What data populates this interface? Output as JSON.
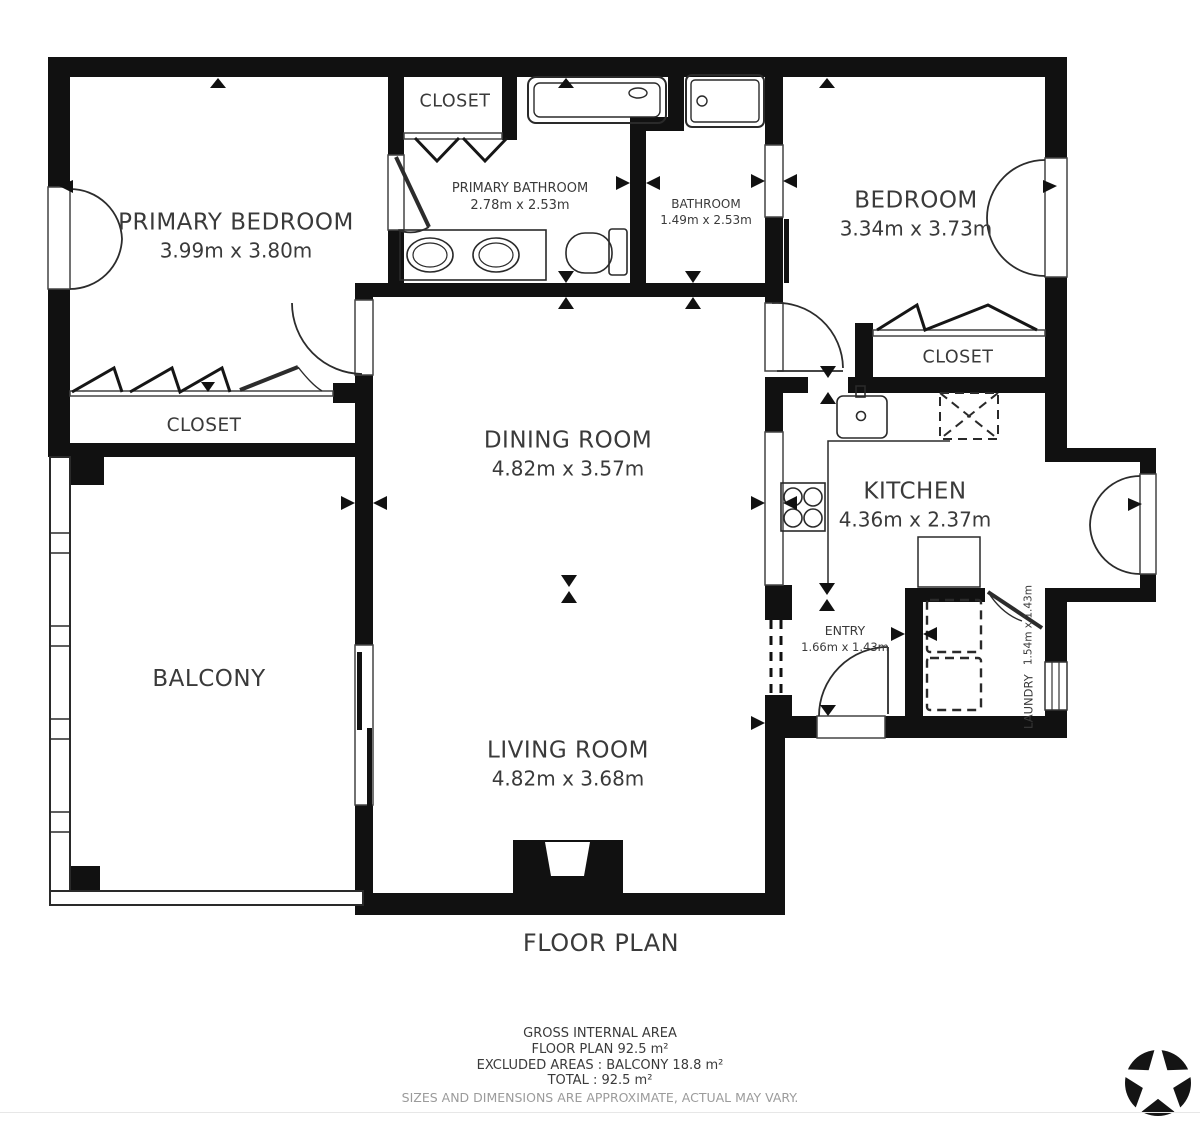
{
  "title": "FLOOR PLAN",
  "rooms": {
    "primary_bedroom": {
      "name": "PRIMARY BEDROOM",
      "dims": "3.99m x 3.80m"
    },
    "closet_top": {
      "name": "CLOSET"
    },
    "primary_bathroom": {
      "name": "PRIMARY BATHROOM",
      "dims": "2.78m x 2.53m"
    },
    "bathroom": {
      "name": "BATHROOM",
      "dims": "1.49m x 2.53m"
    },
    "bedroom": {
      "name": "BEDROOM",
      "dims": "3.34m x 3.73m"
    },
    "closet_right": {
      "name": "CLOSET"
    },
    "closet_left": {
      "name": "CLOSET"
    },
    "dining_room": {
      "name": "DINING ROOM",
      "dims": "4.82m x 3.57m"
    },
    "kitchen": {
      "name": "KITCHEN",
      "dims": "4.36m x 2.37m"
    },
    "balcony": {
      "name": "BALCONY"
    },
    "entry": {
      "name": "ENTRY",
      "dims": "1.66m x 1.43m"
    },
    "laundry": {
      "name": "LAUNDRY",
      "dims": "1.54m x 1.43m"
    },
    "living_room": {
      "name": "LIVING ROOM",
      "dims": "4.82m x 3.68m"
    }
  },
  "summary": {
    "line1": "GROSS INTERNAL AREA",
    "line2": "FLOOR PLAN 92.5 m²",
    "line3": "EXCLUDED AREAS :  BALCONY 18.8 m²",
    "line4": "TOTAL :  92.5 m²",
    "disclaimer": "SIZES AND DIMENSIONS ARE APPROXIMATE, ACTUAL MAY VARY."
  },
  "icons": {
    "logo": "star-pinwheel-logo"
  },
  "colors": {
    "wall": "#111111",
    "text": "#3a3a3a",
    "muted": "#9b9b9b",
    "background": "#ffffff"
  }
}
